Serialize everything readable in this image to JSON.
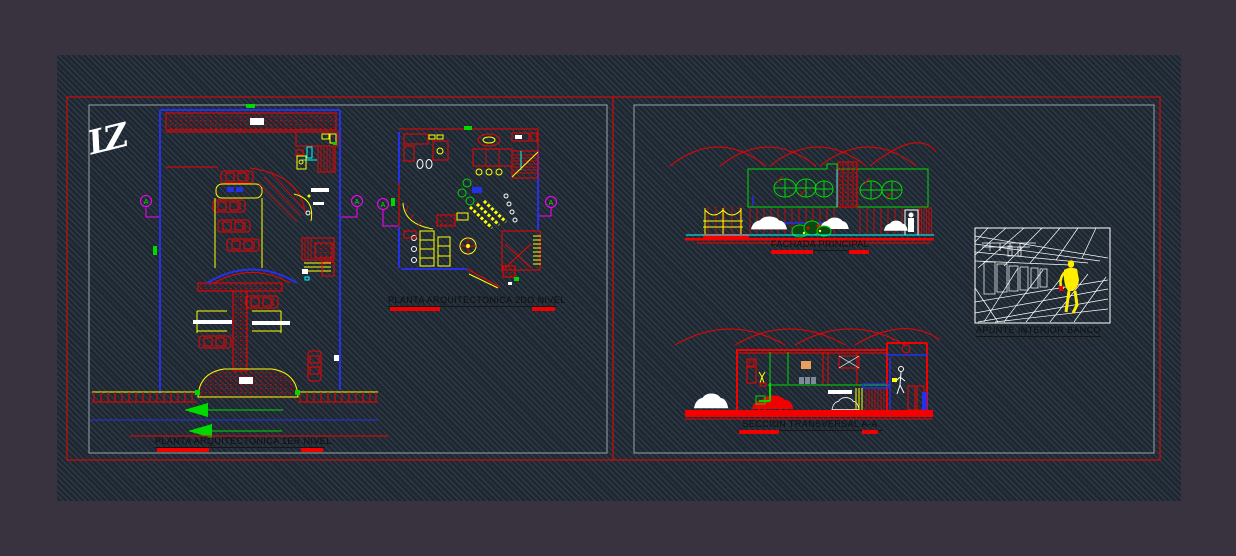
{
  "sheet": {
    "background_color": "#39323f",
    "canvas_color": "#1f2831",
    "frame_red": "#f40000",
    "frame_gray": "#9aa0a6",
    "title_text_color": "#0e0e0e"
  },
  "palette": {
    "red": "#f40000",
    "blue": "#2531e8",
    "yellow": "#ffff00",
    "green": "#00d900",
    "cyan": "#00ffff",
    "magenta": "#ff00ff",
    "white": "#ffffff",
    "orange_picture": "#e8a060",
    "figure_yellow": "#ffee00"
  },
  "logo": {
    "text": "LZ"
  },
  "grid_marker": "A",
  "drawings": {
    "plan1": {
      "label": "PLANTA ARQUITECTONICA 1ER NIVEL"
    },
    "plan2": {
      "label": "PLANTA ARQUITECTONICA 2DO NIVEL"
    },
    "fachada": {
      "label": "FACHADA PRINCIPAL"
    },
    "seccion": {
      "label": "SECCION TRANSVERSAL A-A"
    },
    "apunte": {
      "label": "APUNTE INTERIOR BANCO"
    }
  }
}
